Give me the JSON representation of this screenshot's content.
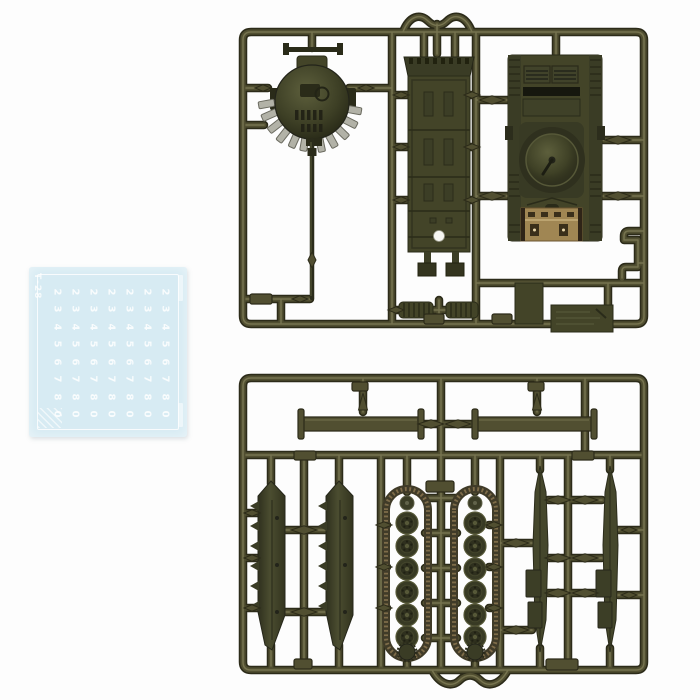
{
  "colors": {
    "background": "#fdfdfd",
    "sprue": "#514f31",
    "sprue_dark": "#2c2b19",
    "sprue_hi": "#8a8760",
    "part": "#434428",
    "part_dark": "#2a2b19",
    "part_hi": "#5f6140",
    "smoke_gray": "#b2b2a7",
    "track_brown": "#7e6c49",
    "rear_tan": "#a08653",
    "decal_bg": "#d7ebf3",
    "decal_mark": "#ffffff"
  },
  "decal_sheet": {
    "side_label": "Т-28",
    "columns": 7,
    "digit_rows": [
      "2",
      "3",
      "4",
      "5",
      "6",
      "7",
      "8",
      "0"
    ]
  }
}
